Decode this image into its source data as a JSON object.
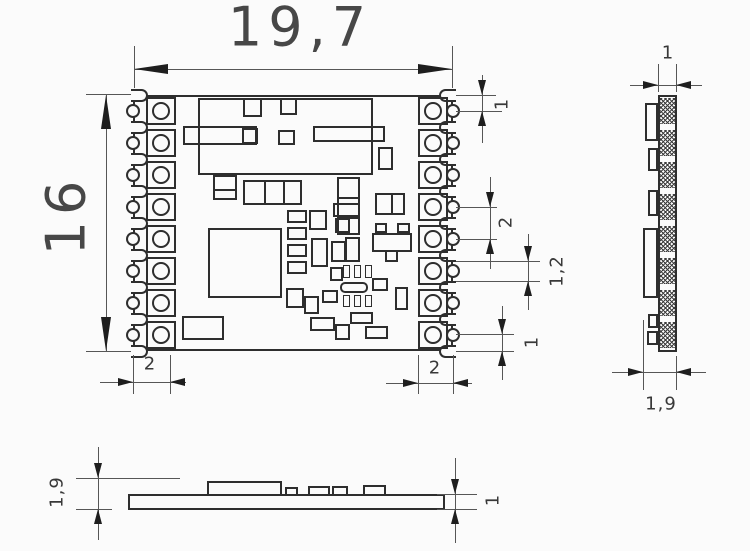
{
  "dims": {
    "top_width": "19,7",
    "left_height": "16",
    "pin_top_offset": "1",
    "pin_pitch": "2",
    "pad_height": "1,2",
    "pin_bottom_offset": "1",
    "pad_length_left": "2",
    "pad_length_right": "2",
    "side_width": "1",
    "side_total_width": "1,9",
    "bottom_total_height": "1,9",
    "bottom_pcb_thickness": "1"
  },
  "colors": {
    "background": "#fbfbfb",
    "outline": "#2e2e2e",
    "dimension_line": "#565656",
    "arrow": "#1e1e1e",
    "text": "#474747"
  },
  "geometry": {
    "top_view": {
      "board": {
        "x": 133,
        "y": 95,
        "w": 320,
        "h": 256
      },
      "pad_centers_y": [
        111,
        143,
        175,
        207,
        239,
        271,
        303,
        335
      ],
      "notch_centers_y": [
        95,
        127,
        159,
        191,
        223,
        255,
        287,
        319,
        351
      ],
      "components": [
        {
          "x": 198,
          "y": 98,
          "w": 175,
          "h": 77
        },
        {
          "x": 243,
          "y": 98,
          "w": 19,
          "h": 19
        },
        {
          "x": 280,
          "y": 98,
          "w": 17,
          "h": 17
        },
        {
          "x": 183,
          "y": 126,
          "w": 74,
          "h": 19
        },
        {
          "x": 242,
          "y": 128,
          "w": 16,
          "h": 16
        },
        {
          "x": 278,
          "y": 130,
          "w": 17,
          "h": 15
        },
        {
          "x": 313,
          "y": 126,
          "w": 72,
          "h": 16
        },
        {
          "x": 378,
          "y": 147,
          "w": 15,
          "h": 23
        },
        {
          "x": 213,
          "y": 175,
          "w": 24,
          "h": 25,
          "dh": 1
        },
        {
          "x": 243,
          "y": 180,
          "w": 59,
          "h": 25,
          "dv": 2
        },
        {
          "x": 337,
          "y": 177,
          "w": 23,
          "h": 58,
          "dh": 2
        },
        {
          "x": 375,
          "y": 193,
          "w": 30,
          "h": 22,
          "dv": 1
        },
        {
          "x": 208,
          "y": 228,
          "w": 74,
          "h": 70
        },
        {
          "x": 287,
          "y": 210,
          "w": 20,
          "h": 13
        },
        {
          "x": 309,
          "y": 210,
          "w": 18,
          "h": 20
        },
        {
          "x": 287,
          "y": 227,
          "w": 20,
          "h": 13
        },
        {
          "x": 311,
          "y": 238,
          "w": 17,
          "h": 29
        },
        {
          "x": 331,
          "y": 241,
          "w": 15,
          "h": 21
        },
        {
          "x": 287,
          "y": 244,
          "w": 20,
          "h": 13
        },
        {
          "x": 287,
          "y": 261,
          "w": 20,
          "h": 13
        },
        {
          "x": 333,
          "y": 203,
          "w": 27,
          "h": 14
        },
        {
          "x": 335,
          "y": 218,
          "w": 15,
          "h": 15
        },
        {
          "x": 330,
          "y": 267,
          "w": 13,
          "h": 14
        },
        {
          "x": 345,
          "y": 237,
          "w": 15,
          "h": 25
        },
        {
          "x": 375,
          "y": 223,
          "w": 12,
          "h": 10
        },
        {
          "x": 397,
          "y": 223,
          "w": 13,
          "h": 10
        },
        {
          "x": 372,
          "y": 233,
          "w": 40,
          "h": 19
        },
        {
          "x": 385,
          "y": 250,
          "w": 13,
          "h": 12
        },
        {
          "x": 343,
          "y": 265,
          "w": 7,
          "h": 13,
          "t": 1
        },
        {
          "x": 354,
          "y": 265,
          "w": 7,
          "h": 13,
          "t": 1
        },
        {
          "x": 365,
          "y": 265,
          "w": 7,
          "h": 13,
          "t": 1
        },
        {
          "x": 340,
          "y": 282,
          "w": 28,
          "h": 11,
          "r": 5
        },
        {
          "x": 343,
          "y": 295,
          "w": 7,
          "h": 12,
          "t": 1
        },
        {
          "x": 354,
          "y": 295,
          "w": 7,
          "h": 12,
          "t": 1
        },
        {
          "x": 365,
          "y": 295,
          "w": 7,
          "h": 12,
          "t": 1
        },
        {
          "x": 286,
          "y": 288,
          "w": 18,
          "h": 20
        },
        {
          "x": 304,
          "y": 296,
          "w": 15,
          "h": 18
        },
        {
          "x": 322,
          "y": 290,
          "w": 16,
          "h": 13
        },
        {
          "x": 372,
          "y": 278,
          "w": 16,
          "h": 13
        },
        {
          "x": 395,
          "y": 287,
          "w": 13,
          "h": 23
        },
        {
          "x": 310,
          "y": 317,
          "w": 25,
          "h": 14
        },
        {
          "x": 335,
          "y": 324,
          "w": 15,
          "h": 16
        },
        {
          "x": 350,
          "y": 312,
          "w": 23,
          "h": 12
        },
        {
          "x": 365,
          "y": 326,
          "w": 23,
          "h": 13
        },
        {
          "x": 182,
          "y": 316,
          "w": 42,
          "h": 24
        }
      ]
    },
    "side_view": {
      "strip": {
        "x": 658,
        "y": 95,
        "w": 19,
        "h": 257
      },
      "hatch_centers_y": [
        111,
        143,
        175,
        207,
        239,
        271,
        303,
        335
      ],
      "components": [
        {
          "x": 645,
          "y": 103,
          "w": 13,
          "h": 38
        },
        {
          "x": 648,
          "y": 148,
          "w": 10,
          "h": 23
        },
        {
          "x": 648,
          "y": 190,
          "w": 10,
          "h": 26
        },
        {
          "x": 643,
          "y": 228,
          "w": 15,
          "h": 70
        },
        {
          "x": 648,
          "y": 314,
          "w": 10,
          "h": 14
        },
        {
          "x": 647,
          "y": 331,
          "w": 11,
          "h": 14
        }
      ]
    },
    "bottom_view": {
      "pcb": {
        "x": 128,
        "y": 494,
        "w": 317,
        "h": 16
      },
      "components": [
        {
          "x": 207,
          "y": 481,
          "w": 75,
          "h": 15
        },
        {
          "x": 285,
          "y": 487,
          "w": 13,
          "h": 9
        },
        {
          "x": 308,
          "y": 486,
          "w": 22,
          "h": 10
        },
        {
          "x": 332,
          "y": 486,
          "w": 16,
          "h": 10
        },
        {
          "x": 363,
          "y": 485,
          "w": 23,
          "h": 11
        }
      ]
    },
    "dim_graphics": {
      "hlines": [
        [
          134,
          69,
          318
        ],
        [
          86,
          94,
          45
        ],
        [
          86,
          351,
          45
        ],
        [
          456,
          95,
          40
        ],
        [
          456,
          111,
          46
        ],
        [
          456,
          207,
          41
        ],
        [
          456,
          239,
          41
        ],
        [
          456,
          261,
          84
        ],
        [
          456,
          281,
          84
        ],
        [
          456,
          334,
          58
        ],
        [
          456,
          351,
          58
        ],
        [
          100,
          382,
          86
        ],
        [
          386,
          383,
          86
        ],
        [
          630,
          85,
          72
        ],
        [
          612,
          372,
          94
        ],
        [
          76,
          478,
          104
        ],
        [
          76,
          509,
          36
        ],
        [
          437,
          494,
          40
        ],
        [
          437,
          509,
          40
        ]
      ],
      "vlines": [
        [
          134,
          46,
          42
        ],
        [
          452,
          46,
          42
        ],
        [
          106,
          94,
          257
        ],
        [
          482,
          75,
          68
        ],
        [
          490,
          177,
          92
        ],
        [
          528,
          234,
          76
        ],
        [
          502,
          306,
          74
        ],
        [
          133,
          355,
          39
        ],
        [
          170,
          355,
          39
        ],
        [
          418,
          355,
          39
        ],
        [
          453,
          355,
          39
        ],
        [
          658,
          64,
          28
        ],
        [
          676,
          64,
          28
        ],
        [
          643,
          320,
          70
        ],
        [
          676,
          356,
          34
        ],
        [
          98,
          447,
          93
        ],
        [
          455,
          458,
          85
        ]
      ],
      "arrows": [
        [
          134,
          69,
          "w",
          "b"
        ],
        [
          452,
          69,
          "e",
          "b"
        ],
        [
          106,
          95,
          "n",
          "b"
        ],
        [
          106,
          351,
          "s",
          "b"
        ],
        [
          482,
          95,
          "s",
          "s"
        ],
        [
          482,
          111,
          "n",
          "s"
        ],
        [
          490,
          207,
          "s",
          "s"
        ],
        [
          490,
          239,
          "n",
          "s"
        ],
        [
          528,
          261,
          "s",
          "s"
        ],
        [
          528,
          281,
          "n",
          "s"
        ],
        [
          502,
          334,
          "s",
          "s"
        ],
        [
          502,
          351,
          "n",
          "s"
        ],
        [
          133,
          382,
          "e",
          "s"
        ],
        [
          170,
          382,
          "w",
          "s"
        ],
        [
          418,
          383,
          "e",
          "s"
        ],
        [
          453,
          383,
          "w",
          "s"
        ],
        [
          658,
          85,
          "e",
          "s"
        ],
        [
          676,
          85,
          "w",
          "s"
        ],
        [
          643,
          372,
          "e",
          "s"
        ],
        [
          676,
          372,
          "w",
          "s"
        ],
        [
          98,
          478,
          "s",
          "s"
        ],
        [
          98,
          509,
          "n",
          "s"
        ],
        [
          455,
          494,
          "s",
          "s"
        ],
        [
          455,
          509,
          "n",
          "s"
        ]
      ]
    }
  }
}
